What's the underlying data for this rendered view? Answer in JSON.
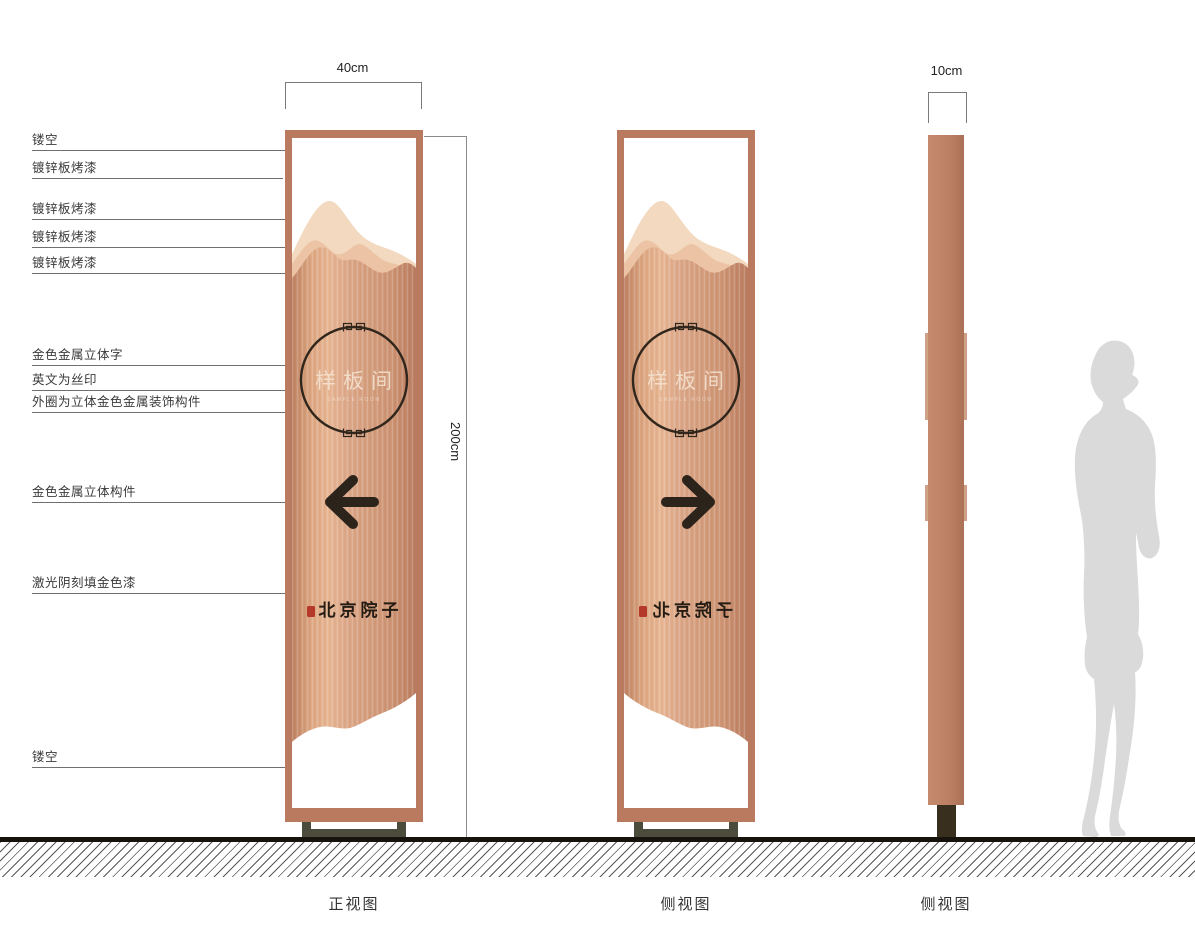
{
  "document": {
    "type": "signage-design-drawing",
    "background": "#ffffff"
  },
  "dimensions": {
    "front_width_label": "40cm",
    "profile_width_label": "10cm",
    "height_label": "200cm"
  },
  "annotations": [
    {
      "label": "镂空"
    },
    {
      "label": "镀锌板烤漆"
    },
    {
      "label": "镀锌板烤漆"
    },
    {
      "label": "镀锌板烤漆"
    },
    {
      "label": "镀锌板烤漆"
    },
    {
      "label": "金色金属立体字"
    },
    {
      "label": "英文为丝印"
    },
    {
      "label": "外圈为立体金色金属装饰构件"
    },
    {
      "label": "金色金属立体构件"
    },
    {
      "label": "激光阴刻填金色漆"
    },
    {
      "label": "镂空"
    }
  ],
  "sign_content": {
    "circle_text": "样板间",
    "english_subtitle": "SAMPLE ROOM",
    "brand_text": "北京院子"
  },
  "views": {
    "front": {
      "caption": "正视图"
    },
    "side_mirrored": {
      "caption": "侧视图"
    },
    "side_profile": {
      "caption": "侧视图"
    }
  },
  "colors": {
    "frame_copper": "#b97a5f",
    "body_copper_light": "#e7b592",
    "body_copper_dark": "#b97b5e",
    "mountain_back": "#f3d9bf",
    "mountain_mid": "#ecc4a5",
    "ink": "#2c231b",
    "seal_red": "#b5392b",
    "stand_olive": "#4c4c3c",
    "silhouette_gray": "#dadada"
  }
}
